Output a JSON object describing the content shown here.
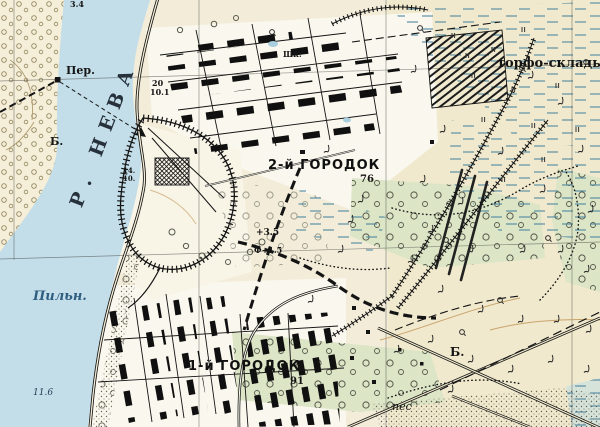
{
  "map": {
    "type": "soviet-topographic-map",
    "region_hint": "Neva river with settlements and peat works",
    "colors": {
      "water": "#c3dee9",
      "paper": "#f2ecd9",
      "paper_east": "#f0e9cd",
      "urban_paper": "#faf8ee",
      "scrub_green": "#dce5c6",
      "marsh_blue": "#4f87a0",
      "ink": "#141414",
      "contour_brown": "#c9a36b",
      "label_blue": "#2f5d80"
    },
    "labels": {
      "river": "Р. НЕВА",
      "ferry": "Пер.",
      "bank_west": "Б.",
      "sawmill": "Пильн.",
      "town2": "2-й ГОРОДОК",
      "town2_elev": "76",
      "town1": "1-й ГОРОДОК",
      "town1_elev": "91",
      "peat_storage": "торфо-склады",
      "school": "Шк.",
      "sand": "пес",
      "b_east": "Б.",
      "depth_34": "3.4",
      "river_20": "20",
      "river_101": "10.1",
      "river_14": "14.",
      "river_10": "10.",
      "depth_116": "11.6",
      "height_35": "+3.5",
      "height_f15": "Ф+1.5"
    },
    "symbols": [
      "marsh-icon",
      "bush-icon",
      "tree-icon",
      "orchard-icon",
      "railway-embankment-icon",
      "building-block-icon",
      "sand-stipple-icon",
      "ferry-route-icon",
      "grid-line"
    ]
  }
}
